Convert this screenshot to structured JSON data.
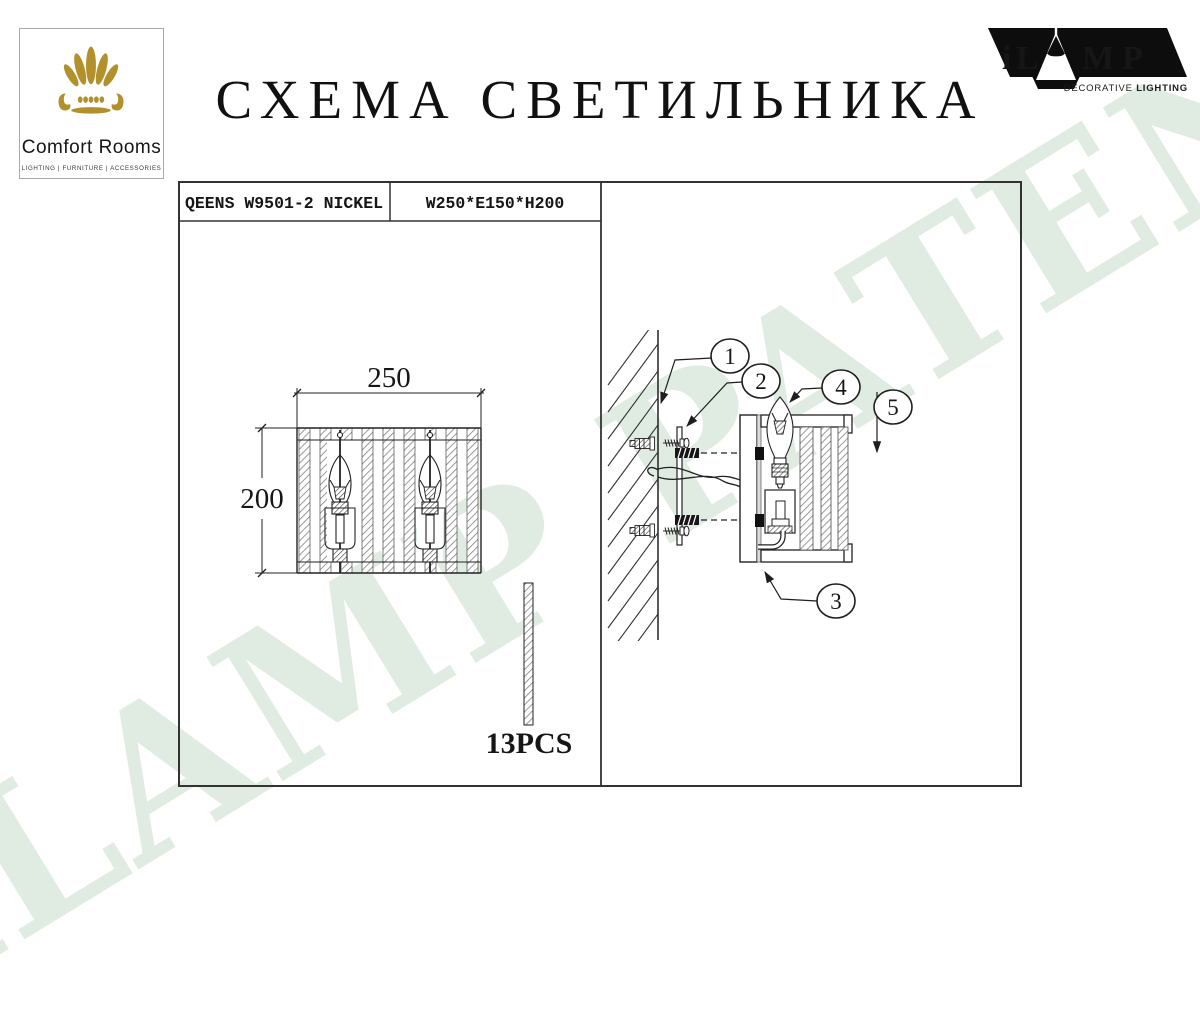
{
  "watermark": {
    "text": "iLAMP PATENTED",
    "color": "#e0ece2"
  },
  "header": {
    "title": "СХЕМА СВЕТИЛЬНИКА",
    "comfort_logo": {
      "name": "Comfort Rooms",
      "tagline": "LIGHTING | FURNITURE | ACCESSORIES",
      "gold": "#b2902c"
    },
    "ilamp_logo": {
      "letter_i": "i",
      "letter_l": "L",
      "letter_m": "M",
      "letter_p": "P",
      "tagline_regular": "DECORATIVE ",
      "tagline_bold": "LIGHTING"
    }
  },
  "spec_table": {
    "model": "QEENS W9501-2 NICKEL",
    "size": "W250*E150*H200"
  },
  "front_view": {
    "width_mm": "250",
    "height_mm": "200",
    "pieces": "13PCS"
  },
  "mounting_view": {
    "callouts": [
      {
        "number": "1"
      },
      {
        "number": "2"
      },
      {
        "number": "3"
      },
      {
        "number": "4"
      },
      {
        "number": "5"
      }
    ]
  }
}
